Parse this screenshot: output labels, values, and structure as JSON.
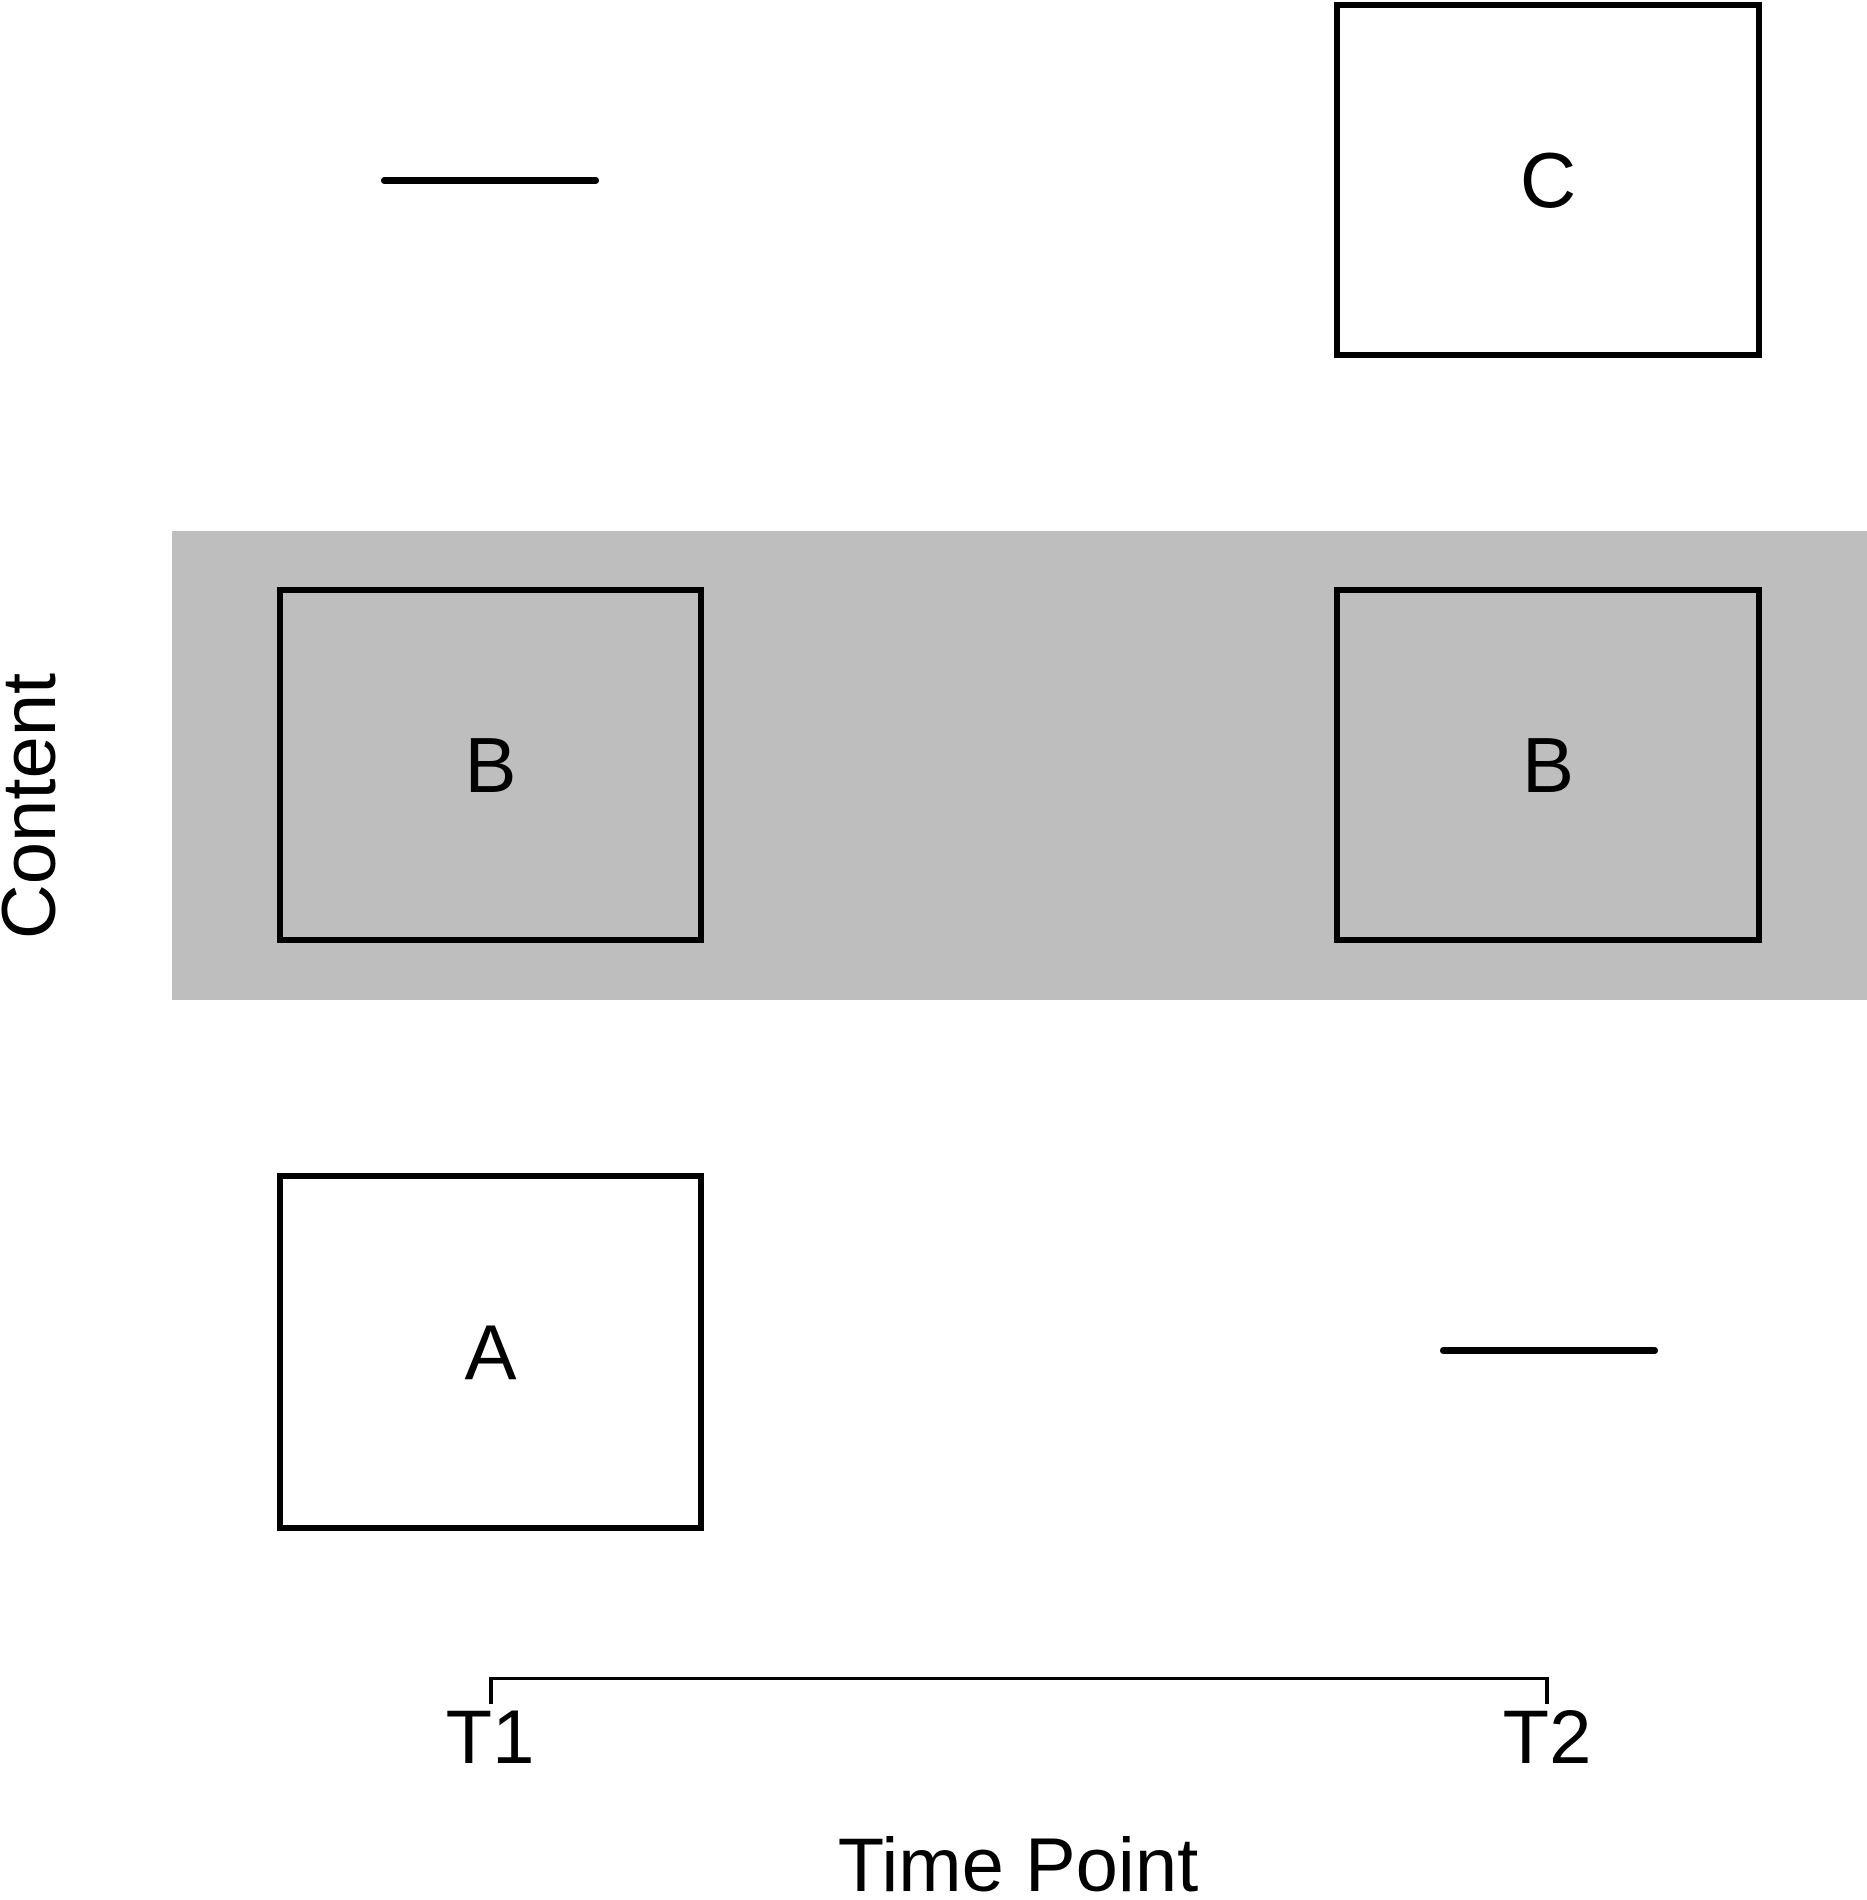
{
  "figure": {
    "type": "schematic-plot",
    "background_color": "#ffffff",
    "stroke_color": "#000000",
    "y_axis": {
      "label": "Content"
    },
    "x_axis": {
      "label": "Time Point",
      "ticks": [
        "T1",
        "T2"
      ]
    },
    "highlight_band": {
      "row": "middle",
      "color": "#bebebe",
      "meaning": "content row shared across both time points"
    },
    "boxes": [
      {
        "label": "A",
        "time": "T1",
        "row": "bottom",
        "fill": "#ffffff",
        "highlighted": false
      },
      {
        "label": "B",
        "time": "T1",
        "row": "middle",
        "fill": "#bebebe",
        "highlighted": true
      },
      {
        "label": "B",
        "time": "T2",
        "row": "middle",
        "fill": "#bebebe",
        "highlighted": true
      },
      {
        "label": "C",
        "time": "T2",
        "row": "top",
        "fill": "#ffffff",
        "highlighted": false
      }
    ],
    "absent_markers": [
      {
        "time": "T1",
        "row": "top",
        "shape": "short-horizontal-line"
      },
      {
        "time": "T2",
        "row": "bottom",
        "shape": "short-horizontal-line"
      }
    ]
  }
}
